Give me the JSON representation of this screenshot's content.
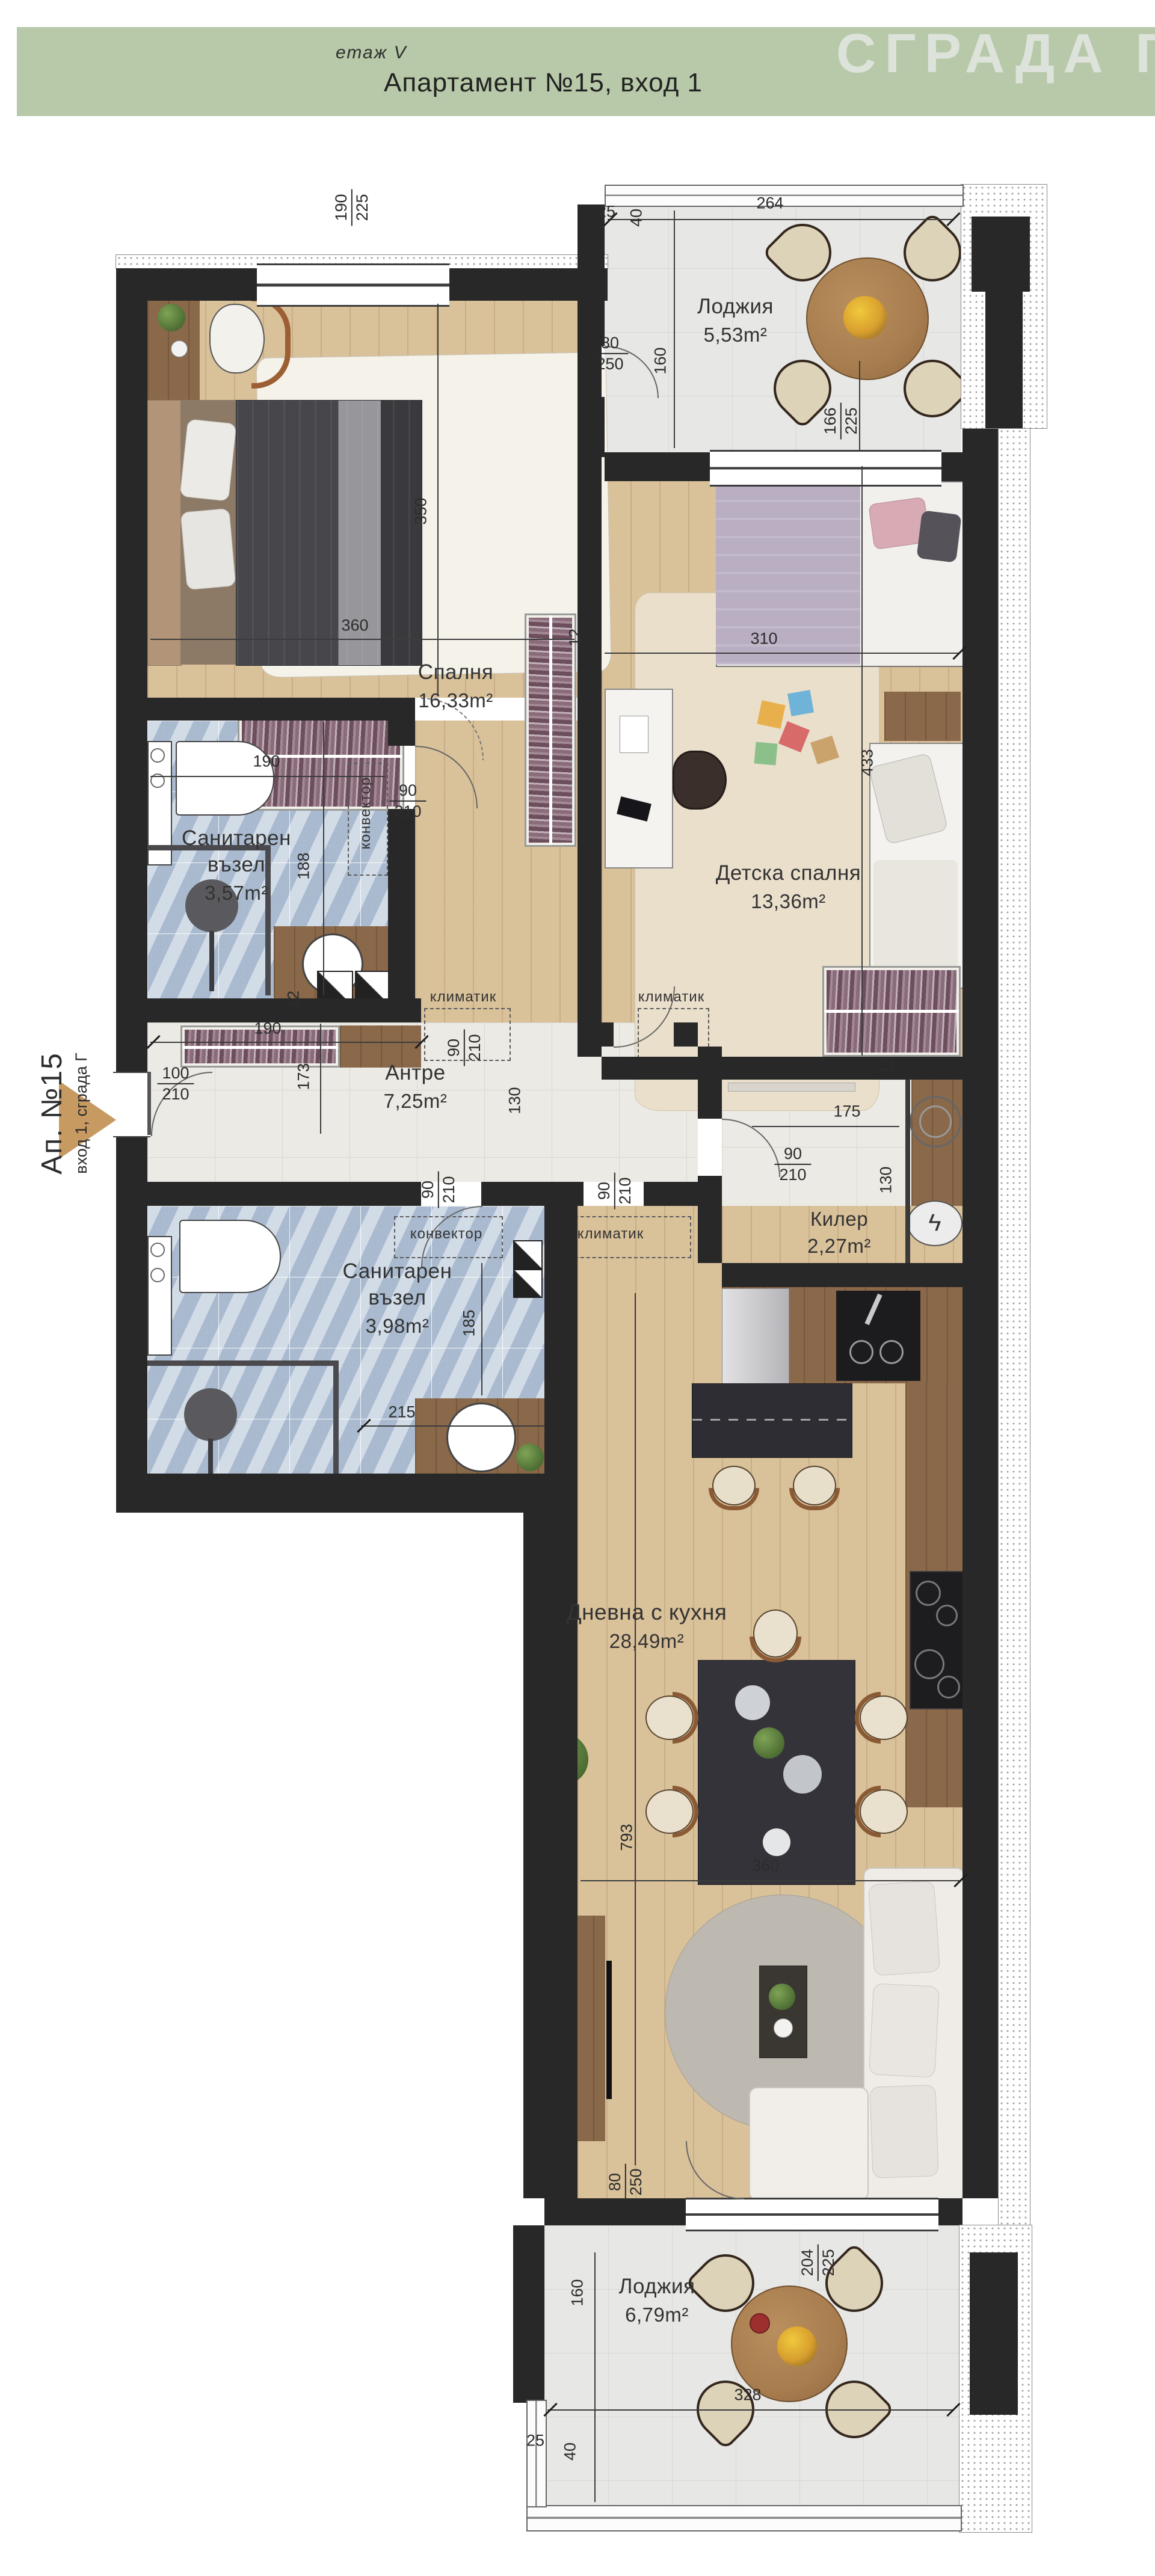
{
  "header": {
    "floor": "етаж V",
    "title": "Апартамент №15, вход 1",
    "watermark": "СГРАДА Г"
  },
  "entrance_label": {
    "primary": "Ап. №15",
    "secondary": "вход 1, сграда Г"
  },
  "rooms": {
    "loggia_top": {
      "name": "Лоджия",
      "area": "5,53m²"
    },
    "bedroom": {
      "name": "Спалня",
      "area": "16,33m²"
    },
    "bath1": {
      "name": "Санитарен възел",
      "area": "3,57m²"
    },
    "kids": {
      "name": "Детска спалня",
      "area": "13,36m²"
    },
    "hall": {
      "name": "Антре",
      "area": "7,25m²"
    },
    "pantry": {
      "name": "Килер",
      "area": "2,27m²"
    },
    "bath2": {
      "name": "Санитарен възел",
      "area": "3,98m²"
    },
    "living": {
      "name": "Дневна с кухня",
      "area": "28,49m²"
    },
    "loggia_bottom": {
      "name": "Лоджия",
      "area": "6,79m²"
    }
  },
  "equipment": {
    "ac": "климатик",
    "convector": "конвектор"
  },
  "dims": {
    "win_bedroom": {
      "top": "190",
      "bottom": "225"
    },
    "a25": "25",
    "a40": "40",
    "a264": "264",
    "a160": "160",
    "a80_250": {
      "top": "80",
      "bottom": "250"
    },
    "a166_225": {
      "top": "166",
      "bottom": "225"
    },
    "a350": "350",
    "a360": "360",
    "a310": "310",
    "a12": "12",
    "a433": "433",
    "b190": "190",
    "b90_210": {
      "top": "90",
      "bottom": "210"
    },
    "b188": "188",
    "b12": "12",
    "h190": "190",
    "h100_210": {
      "top": "100",
      "bottom": "210"
    },
    "h173": "173",
    "h90_210": {
      "top": "90",
      "bottom": "210"
    },
    "h130": "130",
    "k175": "175",
    "k90_210": {
      "top": "90",
      "bottom": "210"
    },
    "k130": "130",
    "k12": "12",
    "w90_210a": {
      "top": "90",
      "bottom": "210"
    },
    "w90_210b": {
      "top": "90",
      "bottom": "210"
    },
    "w185": "185",
    "w215": "215",
    "l793": "793",
    "l360": "360",
    "g80_250": {
      "top": "80",
      "bottom": "250"
    },
    "g204_225": {
      "top": "204",
      "bottom": "225"
    },
    "g160": "160",
    "g328": "328",
    "g25": "25",
    "g40": "40"
  },
  "colors": {
    "header_band": "#b7c9a8",
    "watermark": "#dde2da",
    "walls": "#282828",
    "wood_floor": "#d9c19a",
    "tile_floor": "#eceae5",
    "bath_tile": "#b6c6d9",
    "entrance_arrow": "#c79a62"
  }
}
